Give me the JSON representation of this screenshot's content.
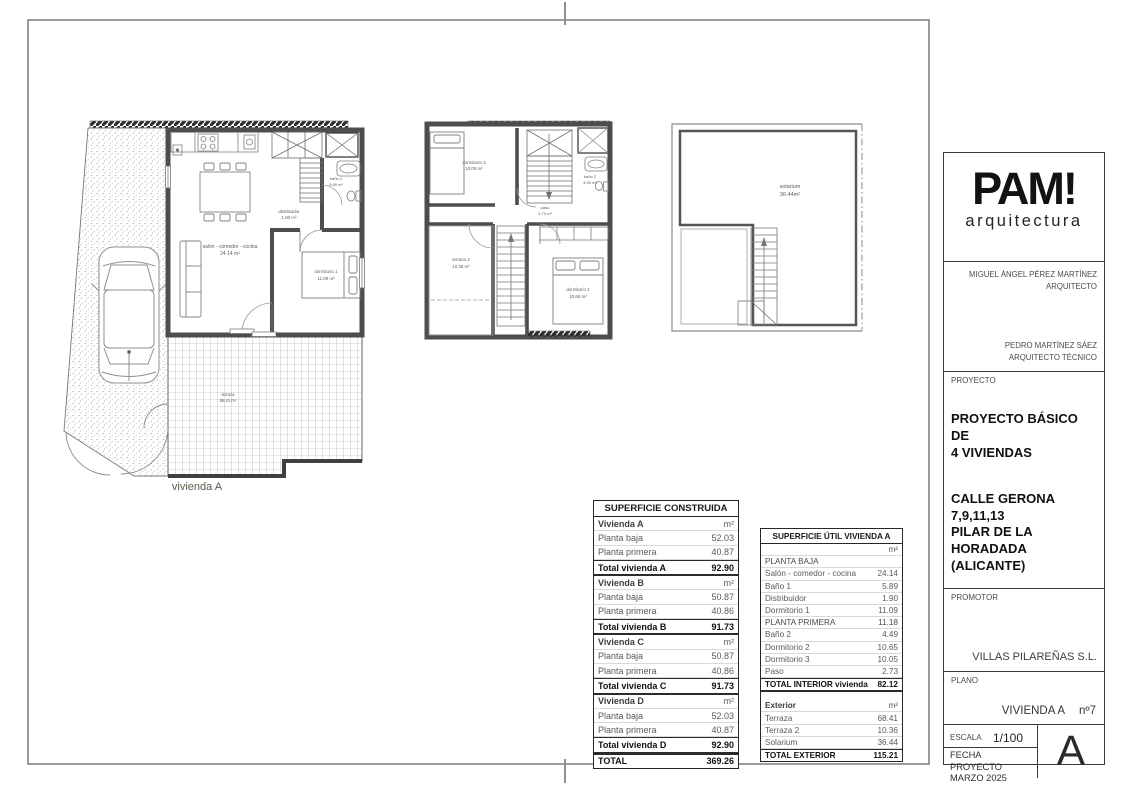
{
  "plans": {
    "ground": {
      "name_label": "vivienda A",
      "rooms": {
        "salon": {
          "label": "salón - comedor - cocina",
          "area": "24.14 m²"
        },
        "distribuidor": {
          "label": "distribuidor",
          "area": "1.90 m²"
        },
        "bano1": {
          "label": "baño 1",
          "area": "5.89 m²"
        },
        "dormitorio1": {
          "label": "dormitorio 1",
          "area": "11.09 m²"
        },
        "terraza": {
          "label": "terraza",
          "area": "68.41 m²"
        }
      }
    },
    "first": {
      "rooms": {
        "dormitorio3": {
          "label": "dormitorio 3",
          "area": "10.05 m²"
        },
        "bano2": {
          "label": "baño 2",
          "area": "4.49 m²"
        },
        "paso": {
          "label": "paso",
          "area": "2.73 m²"
        },
        "terraza2": {
          "label": "terraza 2",
          "area": "10.36 m²"
        },
        "dormitorio2": {
          "label": "dormitorio 2",
          "area": "10.65 m²"
        }
      }
    },
    "solarium": {
      "rooms": {
        "solarium": {
          "label": "solarium",
          "area": "36.44m²"
        }
      }
    }
  },
  "tables": {
    "construida": {
      "title": "SUPERFICIE CONSTRUIDA",
      "rows": [
        {
          "label": "Vivienda A",
          "value": "m²",
          "cls": "sec"
        },
        {
          "label": "Planta baja",
          "value": "52.03",
          "cls": "row"
        },
        {
          "label": "Planta primera",
          "value": "40.87",
          "cls": "row"
        },
        {
          "label": "Total vivienda A",
          "value": "92.90",
          "cls": "tot"
        },
        {
          "label": "Vivienda B",
          "value": "m²",
          "cls": "sec"
        },
        {
          "label": "Planta baja",
          "value": "50.87",
          "cls": "row"
        },
        {
          "label": "Planta primera",
          "value": "40.86",
          "cls": "row"
        },
        {
          "label": "Total vivienda B",
          "value": "91.73",
          "cls": "tot"
        },
        {
          "label": "Vivienda C",
          "value": "m²",
          "cls": "sec"
        },
        {
          "label": "Planta baja",
          "value": "50.87",
          "cls": "row"
        },
        {
          "label": "Planta primera",
          "value": "40.86",
          "cls": "row"
        },
        {
          "label": "Total vivienda C",
          "value": "91.73",
          "cls": "tot"
        },
        {
          "label": "Vivienda D",
          "value": "m²",
          "cls": "sec"
        },
        {
          "label": "Planta baja",
          "value": "52.03",
          "cls": "row"
        },
        {
          "label": "Planta primera",
          "value": "40.87",
          "cls": "row"
        },
        {
          "label": "Total vivienda D",
          "value": "92.90",
          "cls": "tot"
        },
        {
          "label": "TOTAL",
          "value": "369.26",
          "cls": "grand"
        }
      ]
    },
    "util": {
      "title": "SUPERFICIE ÚTIL VIVIENDA A",
      "rows": [
        {
          "label": "",
          "value": "m²",
          "cls": "sec"
        },
        {
          "label": "PLANTA BAJA",
          "value": "",
          "cls": "caps"
        },
        {
          "label": "Salón - comedor - cocina",
          "value": "24.14",
          "cls": "row"
        },
        {
          "label": "Baño 1",
          "value": "5.89",
          "cls": "row"
        },
        {
          "label": "Distribuidor",
          "value": "1.90",
          "cls": "row"
        },
        {
          "label": "Dormitorio 1",
          "value": "11.09",
          "cls": "row"
        },
        {
          "label": "PLANTA PRIMERA",
          "value": "11.18",
          "cls": "caps"
        },
        {
          "label": "Baño 2",
          "value": "4.49",
          "cls": "row"
        },
        {
          "label": "Dormitorio 2",
          "value": "10.65",
          "cls": "row"
        },
        {
          "label": "Dormitorio 3",
          "value": "10.05",
          "cls": "row"
        },
        {
          "label": "Paso",
          "value": "2.73",
          "cls": "row"
        },
        {
          "label": "TOTAL INTERIOR vivienda",
          "value": "82.12",
          "cls": "grand"
        },
        {
          "label": "",
          "value": "",
          "cls": "gap"
        },
        {
          "label": "Exterior",
          "value": "m²",
          "cls": "sec"
        },
        {
          "label": "Terraza",
          "value": "68.41",
          "cls": "row"
        },
        {
          "label": "Terraza 2",
          "value": "10.36",
          "cls": "row"
        },
        {
          "label": "Solarium",
          "value": "36.44",
          "cls": "row"
        },
        {
          "label": "TOTAL EXTERIOR",
          "value": "115.21",
          "cls": "grand"
        }
      ]
    }
  },
  "titleblock": {
    "logo": {
      "main": "PAM!",
      "sub": "arquitectura"
    },
    "architect1": {
      "name": "MIGUEL ÁNGEL PÉREZ MARTÍNEZ",
      "role": "ARQUITECTO"
    },
    "architect2": {
      "name": "PEDRO MARTÍNEZ SÁEZ",
      "role": "ARQUITECTO TÉCNICO"
    },
    "proyecto": {
      "label": "PROYECTO",
      "title": "PROYECTO BÁSICO DE\n4 VIVIENDAS",
      "address": "CALLE GERONA\n7,9,11,13\nPILAR DE LA HORADADA\n(ALICANTE)"
    },
    "promotor": {
      "label": "PROMOTOR",
      "value": "VILLAS PILAREÑAS S.L."
    },
    "plano": {
      "label": "PLANO",
      "value": "VIVIENDA A",
      "number": "nº7"
    },
    "escala": {
      "label": "ESCALA",
      "value": "1/100"
    },
    "fecha": {
      "label": "FECHA PROYECTO",
      "value": "MARZO 2025"
    },
    "sheet_letter": "A"
  },
  "colors": {
    "frame": "#9c9c9c",
    "wall": "#4d4d4d",
    "furniture_line": "#7d7d7d",
    "table_text": "#595959",
    "accent_text": "#111111"
  }
}
